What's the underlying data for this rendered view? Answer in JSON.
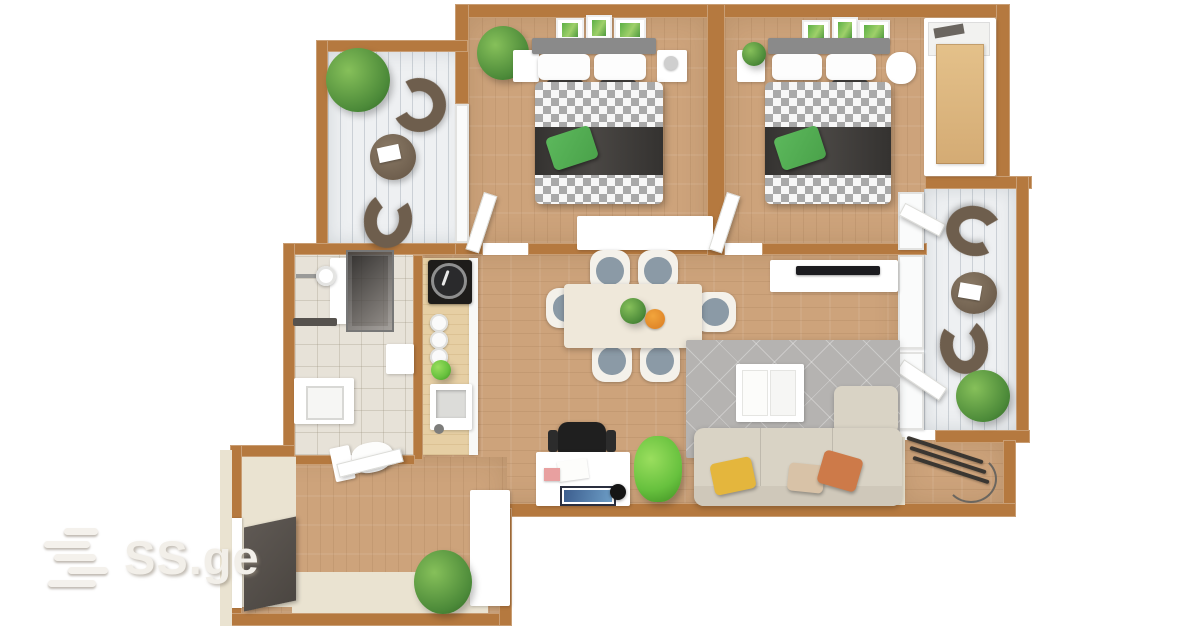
{
  "watermark": {
    "text": "SS.ge"
  },
  "palette": {
    "wall": "#b5793f",
    "wall_light": "#eae3d1",
    "wood": "#cda37b",
    "plank": "#eef0f2",
    "tile": "#e7e2d8",
    "counter": "#e6cfa4",
    "chair_brown": "#6e5e4d",
    "sofa": "#d9d3c5",
    "rug": "#b5b3b1",
    "seat": "#8b9aa6",
    "green_dark": "#4c8a39",
    "green_bright": "#67c13e",
    "pillow_green": "#4aa24a",
    "pillow_yellow": "#e4b63d",
    "pillow_orange": "#cd7a49",
    "pillow_beige": "#d8c2a7",
    "headboard": "#8a8a8a",
    "dark": "#2e2c29"
  },
  "plan": {
    "type": "apartment-floor-plan-3d-top-view",
    "rooms": {
      "balcony_top_left": {
        "furniture": [
          "potted-plant",
          "curved-lounge-chair",
          "round-table-with-magazine",
          "curved-lounge-chair"
        ]
      },
      "bedroom_1": {
        "furniture": [
          "wall-art-x3",
          "double-bed-checkered-duvet",
          "green-pillow",
          "nightstand-left",
          "nightstand-right",
          "corner-plant",
          "dresser",
          "open-door"
        ]
      },
      "bedroom_2": {
        "furniture": [
          "wall-art-x3",
          "double-bed-checkered-duvet",
          "green-pillow",
          "nightstand-with-plant",
          "soft-toy",
          "wardrobe",
          "open-door"
        ]
      },
      "balcony_right": {
        "furniture": [
          "curved-lounge-chair",
          "round-table-with-magazine",
          "curved-lounge-chair",
          "potted-plant"
        ]
      },
      "living_dining_room": {
        "furniture": [
          "dining-table",
          "six-dining-chairs",
          "centerpiece-plant",
          "fruit-bowl",
          "tv-console",
          "tv",
          "gray-rug",
          "coffee-table",
          "sofa-with-chaise",
          "pillow-yellow",
          "pillow-beige",
          "pillow-orange",
          "desk",
          "office-chair",
          "monitor",
          "desk-lamp",
          "desk-plant"
        ]
      },
      "bathroom": {
        "furniture": [
          "shower-cabin",
          "shower-arm",
          "wall-shelf",
          "cabinet",
          "washing-machine",
          "toilet",
          "open-door"
        ]
      },
      "kitchen": {
        "furniture": [
          "cooktop",
          "pan",
          "plates-stack",
          "small-plant",
          "sink-with-faucet"
        ]
      },
      "hallway_entry": {
        "furniture": [
          "entry-doormat",
          "storage-cabinet",
          "potted-plant"
        ]
      },
      "utility_nook": {
        "furniture": [
          "drying-rack"
        ]
      }
    }
  }
}
